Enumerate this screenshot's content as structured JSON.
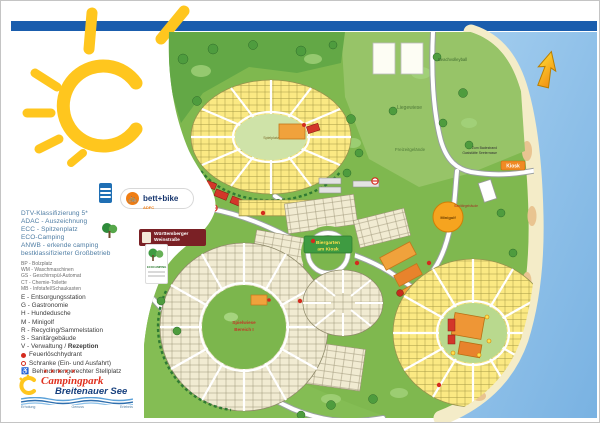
{
  "certifications": [
    "DTV-Klassifizierung 5*",
    "ADAC - Auszeichnung",
    "ECC - Spitzenplatz",
    "ECO-Camping",
    "ANWB - erkende camping",
    "bestklassifizierter Großbetrieb"
  ],
  "legend_small": [
    "BP - Bolzplatz",
    "WM - Waschmaschinen",
    "GS - Geschirrspül-Automat",
    "CT - Chemie-Toilette",
    "MB - Infotafel/Schaukasten"
  ],
  "legend": [
    "E - Entsorgungsstation",
    "G - Gastronomie",
    "H - Hundedusche",
    "M - Minigolf",
    "R - Recycling/Sammelstation",
    "S - Sanitärgebäude"
  ],
  "legend_v": {
    "prefix": "V - Verwaltung / ",
    "bold": "Rezeption"
  },
  "legend_special": {
    "hydrant": "Feuerlöschhydrant",
    "barrier": "Schranke (Ein- und Ausfahrt)",
    "wheelchair_icon": "♿",
    "wheelchair": "Behindertengerechter Stellplatz"
  },
  "logos": {
    "bett_bike": "bett+bike",
    "bett_bike_sub": "ADFC",
    "bike_icon": "🚲",
    "weinstrasse_line1": "Württemberger",
    "weinstrasse_line2": "Weinstraße",
    "badge_title": "ECOCAMPING"
  },
  "brand": {
    "stars": "★★★★★",
    "script": "Campingpark",
    "name": "Breitenauer See",
    "tagline_1": "Erholung",
    "tagline_2": "Genuss",
    "tagline_3": "Erlebnis"
  },
  "map_labels": {
    "beachvolleyball": "Beachvolleyball",
    "liegewiese": "Liegewiese",
    "freizeit": "Freizeitgelände",
    "zum_strand": "Zum Badestrand",
    "seeterrasse": "Gaststätte Seeterrasse",
    "kiosk": "Kiosk",
    "minigolf": "Minigolf",
    "biergarten_1": "Biergarten",
    "biergarten_2": "am Kiosk",
    "spielwiese_1": "Spielwiese",
    "spielwiese_2": "Bereich I",
    "spielplatz": "Spielplatz",
    "sanitaer": "Sanitärgebäude"
  },
  "colors": {
    "accent_blue": "#1a5dad",
    "sun_yellow": "#ffc61e",
    "water": "#8fc1e9",
    "meadow": "#7fb84f",
    "plot_yellow": "#fbe983",
    "plot_beige": "#f1ebd2",
    "marker_red": "#d42b1e"
  }
}
